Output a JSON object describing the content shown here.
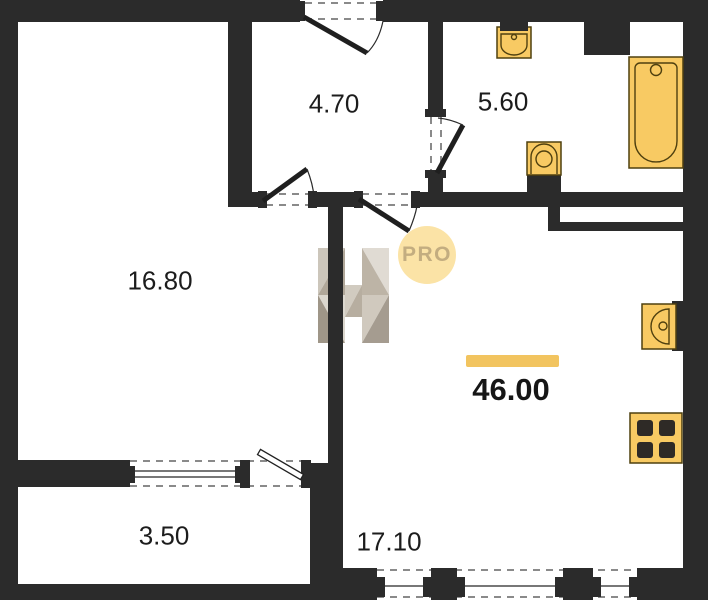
{
  "plan": {
    "title": "apartment-floor-plan",
    "rooms": {
      "hallway": {
        "area": "4.70"
      },
      "bathroom": {
        "area": "5.60"
      },
      "bedroom": {
        "area": "16.80"
      },
      "kitchen_living": {
        "area": "17.10"
      },
      "balcony": {
        "area": "3.50"
      }
    },
    "total_area": "46.00",
    "badge_label": "PRO",
    "fixtures": [
      "wash-basin",
      "toilet",
      "bathtub",
      "kitchen-sink",
      "stove"
    ]
  },
  "colors": {
    "wall": "#2b2b2b",
    "fixture": "#f8ca63",
    "fixture_stroke": "#4f400f",
    "accent": "#f2c45f",
    "badge_bg": "#fbe3a4",
    "badge_text": "#c2ab7c",
    "dash": "#8a8a8a",
    "text": "#1c1c1c"
  }
}
